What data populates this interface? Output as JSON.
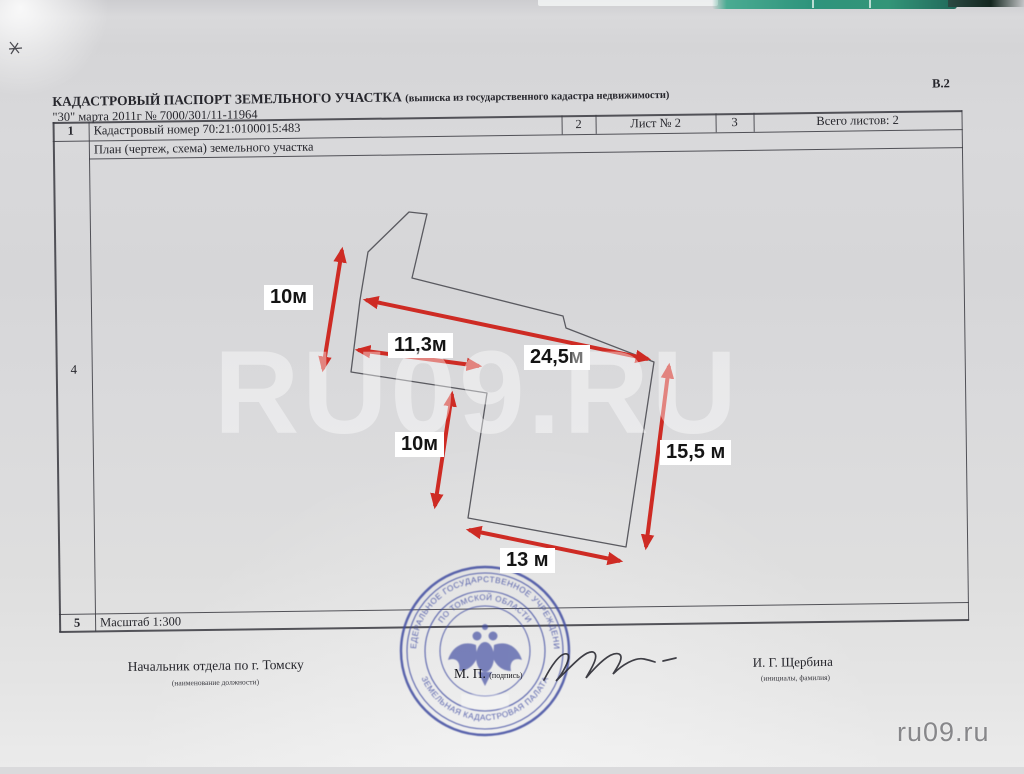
{
  "document": {
    "code": "В.2",
    "title": "КАДАСТРОВЫЙ ПАСПОРТ ЗЕМЕЛЬНОГО УЧАСТКА",
    "title_note": "(выписка из государственного кадастра недвижимости)",
    "date_number_line": "\"30\" марта 2011г № 7000/301/11-11964"
  },
  "table": {
    "row1_num": "1",
    "cadastral_line": "Кадастровый номер 70:21:0100015:483",
    "col2_num": "2",
    "sheet": "Лист № 2",
    "col3_num": "3",
    "total_sheets": "Всего листов: 2",
    "plan_title": "План (чертеж, схема) земельного участка",
    "plan_row_num": "4",
    "scale_row_num": "5",
    "scale": "Масштаб 1:300"
  },
  "plan": {
    "arrow_color": "#ce2b24",
    "outline_color": "#5a5a60",
    "dimensions": [
      {
        "label": "10м"
      },
      {
        "label": "11,3м"
      },
      {
        "label": "24,5м"
      },
      {
        "label": "10м"
      },
      {
        "label": "15,5 м"
      },
      {
        "label": "13 м"
      }
    ]
  },
  "signing": {
    "position": "Начальник отдела по г. Томску",
    "position_note": "(наименование должности)",
    "mp": "М. П.",
    "mp_note": "(подпись)",
    "name": "И. Г. Щербина",
    "name_note": "(инициалы, фамилия)"
  },
  "stamp": {
    "outer_text": "ФЕДЕРАЛЬНОЕ ГОСУДАРСТВЕННОЕ УЧРЕЖДЕНИЕ",
    "bottom_text": "ЗЕМЕЛЬНАЯ КАДАСТРОВАЯ ПАЛАТА",
    "inner_text": "ПО ТОМСКОЙ ОБЛАСТИ",
    "color": "#3e4aa0"
  },
  "watermarks": {
    "large": "RU09.RU",
    "small": "ru09.ru"
  }
}
